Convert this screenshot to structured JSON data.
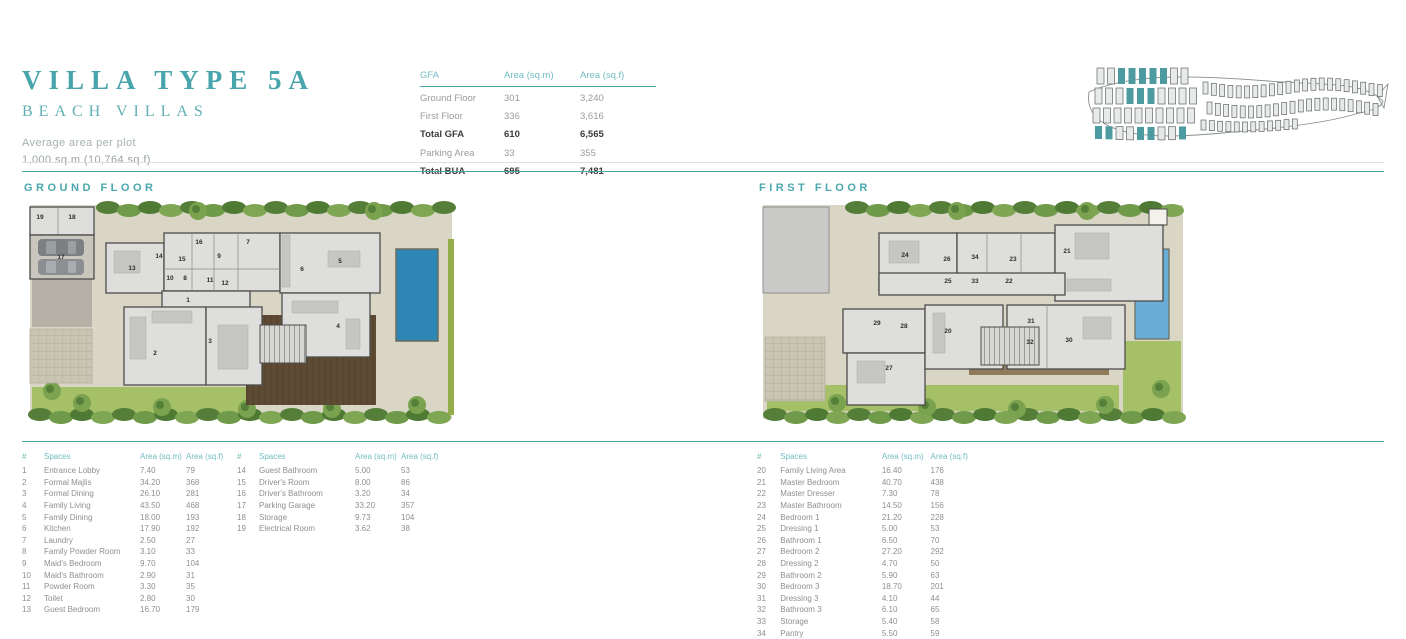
{
  "colors": {
    "accent": "#4aa7ad",
    "title": "#48a5ab",
    "subtitle": "#62afb4",
    "header_teal": "#72bcc1",
    "text_gray": "#9b9b9b",
    "text_dark": "#3c3c3c",
    "plot": "#d9d6c5",
    "pool_ground": "#2e86b4",
    "pool_first": "#6aaed6",
    "lawn": "#a6c068",
    "olive": "#93ad4a",
    "deck_dark": "#5e4b34",
    "deck_tan": "#8f7a5c",
    "room_fill": "#dededc",
    "wall": "#4c4c4c",
    "paving": "#b5b1a7",
    "masterplan_highlight": "#4d9aa0"
  },
  "header": {
    "title": "VILLA TYPE 5A",
    "subtitle": "BEACH VILLAS",
    "avg_label": "Average area per plot",
    "avg_value": "1,000 sq.m (10,764 sq.f)"
  },
  "gfa_table": {
    "headers": [
      "GFA",
      "Area (sq.m)",
      "Area (sq.f)"
    ],
    "rows": [
      {
        "cells": [
          "Ground Floor",
          "301",
          "3,240"
        ]
      },
      {
        "cells": [
          "First Floor",
          "336",
          "3,616"
        ]
      },
      {
        "cells": [
          "Total GFA",
          "610",
          "6,565"
        ],
        "bold": true
      },
      {
        "cells": [
          "Parking Area",
          "33",
          "355"
        ]
      },
      {
        "cells": [
          "Total BUA",
          "695",
          "7,481"
        ],
        "bold": true
      }
    ]
  },
  "sections": {
    "ground": {
      "label": "GROUND FLOOR"
    },
    "first": {
      "label": "FIRST FLOOR"
    }
  },
  "plans": {
    "ground": {
      "rooms": [
        {
          "n": "19",
          "x": 18,
          "y": 20
        },
        {
          "n": "18",
          "x": 50,
          "y": 20
        },
        {
          "n": "17",
          "x": 39,
          "y": 60
        },
        {
          "n": "13",
          "x": 110,
          "y": 71
        },
        {
          "n": "14",
          "x": 137,
          "y": 59
        },
        {
          "n": "15",
          "x": 160,
          "y": 62
        },
        {
          "n": "16",
          "x": 177,
          "y": 45
        },
        {
          "n": "9",
          "x": 197,
          "y": 59
        },
        {
          "n": "7",
          "x": 226,
          "y": 45
        },
        {
          "n": "10",
          "x": 148,
          "y": 81
        },
        {
          "n": "8",
          "x": 163,
          "y": 81
        },
        {
          "n": "11",
          "x": 188,
          "y": 83
        },
        {
          "n": "12",
          "x": 203,
          "y": 86
        },
        {
          "n": "6",
          "x": 280,
          "y": 72
        },
        {
          "n": "5",
          "x": 318,
          "y": 64
        },
        {
          "n": "1",
          "x": 166,
          "y": 103
        },
        {
          "n": "2",
          "x": 133,
          "y": 156
        },
        {
          "n": "3",
          "x": 188,
          "y": 144
        },
        {
          "n": "4",
          "x": 316,
          "y": 129
        }
      ]
    },
    "first": {
      "rooms": [
        {
          "n": "24",
          "x": 148,
          "y": 58
        },
        {
          "n": "26",
          "x": 190,
          "y": 62
        },
        {
          "n": "34",
          "x": 218,
          "y": 60
        },
        {
          "n": "23",
          "x": 256,
          "y": 62
        },
        {
          "n": "21",
          "x": 310,
          "y": 54
        },
        {
          "n": "25",
          "x": 191,
          "y": 84
        },
        {
          "n": "33",
          "x": 218,
          "y": 84
        },
        {
          "n": "22",
          "x": 252,
          "y": 84
        },
        {
          "n": "29",
          "x": 120,
          "y": 126
        },
        {
          "n": "28",
          "x": 147,
          "y": 129
        },
        {
          "n": "20",
          "x": 191,
          "y": 134
        },
        {
          "n": "27",
          "x": 132,
          "y": 171
        },
        {
          "n": "31",
          "x": 274,
          "y": 124
        },
        {
          "n": "32",
          "x": 273,
          "y": 145
        },
        {
          "n": "30",
          "x": 312,
          "y": 143
        }
      ]
    }
  },
  "legend_tables": [
    {
      "headers": [
        "#",
        "Spaces",
        "Area (sq.m)",
        "Area (sq.f)"
      ],
      "rows": [
        [
          "1",
          "Entrance Lobby",
          "7.40",
          "79"
        ],
        [
          "2",
          "Formal Majlis",
          "34.20",
          "368"
        ],
        [
          "3",
          "Formal Dining",
          "26.10",
          "281"
        ],
        [
          "4",
          "Family Living",
          "43.50",
          "468"
        ],
        [
          "5",
          "Family Dining",
          "18.00",
          "193"
        ],
        [
          "6",
          "Kitchen",
          "17.90",
          "192"
        ],
        [
          "7",
          "Laundry",
          "2.50",
          "27"
        ],
        [
          "8",
          "Family Powder Room",
          "3.10",
          "33"
        ],
        [
          "9",
          "Maid's Bedroom",
          "9.70",
          "104"
        ],
        [
          "10",
          "Maid's Bathroom",
          "2.90",
          "31"
        ],
        [
          "11",
          "Powder Room",
          "3.30",
          "35"
        ],
        [
          "12",
          "Toilet",
          "2.80",
          "30"
        ],
        [
          "13",
          "Guest Bedroom",
          "16.70",
          "179"
        ]
      ]
    },
    {
      "headers": [
        "#",
        "Spaces",
        "Area (sq.m)",
        "Area (sq.f)"
      ],
      "rows": [
        [
          "14",
          "Guest Bathroom",
          "5.00",
          "53"
        ],
        [
          "15",
          "Driver's Room",
          "8.00",
          "86"
        ],
        [
          "16",
          "Driver's Bathroom",
          "3.20",
          "34"
        ],
        [
          "17",
          "Parking Garage",
          "33.20",
          "357"
        ],
        [
          "18",
          "Storage",
          "9.73",
          "104"
        ],
        [
          "19",
          "Electrical Room",
          "3.62",
          "38"
        ]
      ]
    },
    {
      "headers": [
        "#",
        "Spaces",
        "Area (sq.m)",
        "Area (sq.f)"
      ],
      "rows": [
        [
          "20",
          "Family Living Area",
          "16.40",
          "176"
        ],
        [
          "21",
          "Master Bedroom",
          "40.70",
          "438"
        ],
        [
          "22",
          "Master Dresser",
          "7.30",
          "78"
        ],
        [
          "23",
          "Master Bathroom",
          "14.50",
          "156"
        ],
        [
          "24",
          "Bedroom 1",
          "21.20",
          "228"
        ],
        [
          "25",
          "Dressing 1",
          "5.00",
          "53"
        ],
        [
          "26",
          "Bathroom 1",
          "6.50",
          "70"
        ],
        [
          "27",
          "Bedroom 2",
          "27.20",
          "292"
        ],
        [
          "28",
          "Dressing 2",
          "4.70",
          "50"
        ],
        [
          "29",
          "Bathroom 2",
          "5.90",
          "63"
        ],
        [
          "30",
          "Bedroom 3",
          "18.70",
          "201"
        ],
        [
          "31",
          "Dressing 3",
          "4.10",
          "44"
        ],
        [
          "32",
          "Bathroom 3",
          "6.10",
          "65"
        ],
        [
          "33",
          "Storage",
          "5.40",
          "58"
        ],
        [
          "34",
          "Pantry",
          "5.50",
          "59"
        ]
      ]
    }
  ]
}
